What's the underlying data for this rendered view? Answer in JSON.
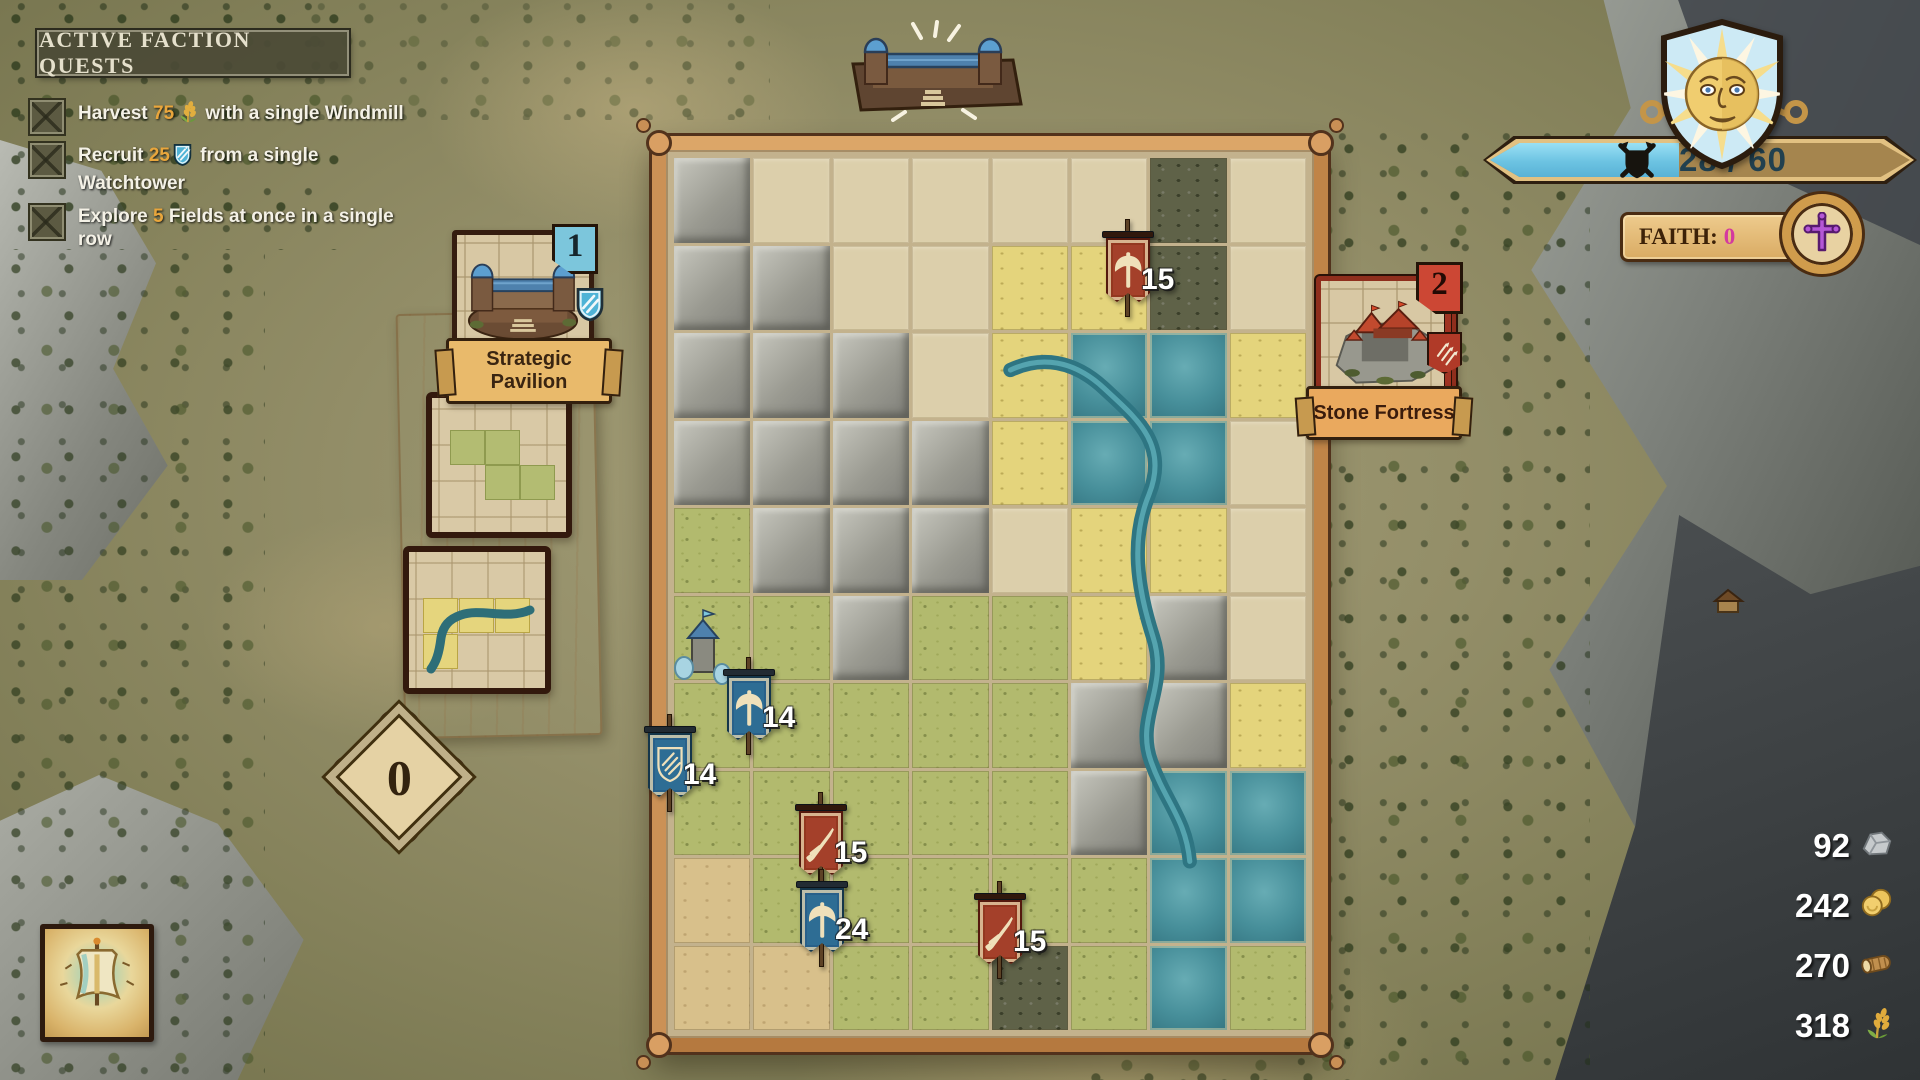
{
  "quests": {
    "title": "ACTIVE FACTION QUESTS",
    "items": [
      {
        "pre": "Harvest ",
        "num": "75",
        "icon": "wheat",
        "mid": " with a single ",
        "bold": "Windmill"
      },
      {
        "pre": "Recruit ",
        "num": "25",
        "icon": "shield",
        "mid": " from a single",
        "bold": "Watchtower"
      },
      {
        "pre": "Explore ",
        "num": "5",
        "icon": "",
        "mid": " Fields at once in a single row",
        "bold": ""
      }
    ]
  },
  "score": {
    "value": "28 / 60",
    "fill_ratio": 0.45
  },
  "faith": {
    "label": "FAITH:",
    "value": "0"
  },
  "cards": {
    "pavilion": {
      "badge": "1",
      "name": "Strategic Pavilion"
    },
    "fortress": {
      "badge": "2",
      "name": "Stone Fortress"
    }
  },
  "hand_counter": {
    "value": "0"
  },
  "board": {
    "tiles": [
      "M.....R.",
      "MM..FFR.",
      "MMM.FWWF",
      "MMMMFWW.",
      "GMMM.FF.",
      "GGMGGFM.",
      "GGGGGMMF",
      "GGGGGMWW",
      "DGGGGGWW",
      "DDGGRGWG"
    ],
    "banners": [
      {
        "icon": "axe",
        "color": "red",
        "count": "15",
        "x": 1128,
        "y": 219
      },
      {
        "icon": "axe",
        "color": "blue",
        "count": "14",
        "x": 749,
        "y": 657
      },
      {
        "icon": "shield",
        "color": "blue",
        "count": "14",
        "x": 670,
        "y": 714
      },
      {
        "icon": "sword",
        "color": "red",
        "count": "15",
        "x": 821,
        "y": 792
      },
      {
        "icon": "axe",
        "color": "blue",
        "count": "24",
        "x": 822,
        "y": 869
      },
      {
        "icon": "sword",
        "color": "red",
        "count": "15",
        "x": 1000,
        "y": 881
      }
    ]
  },
  "resources": [
    {
      "name": "stone",
      "value": "92"
    },
    {
      "name": "gold",
      "value": "242"
    },
    {
      "name": "wood",
      "value": "270"
    },
    {
      "name": "wheat",
      "value": "318"
    }
  ]
}
